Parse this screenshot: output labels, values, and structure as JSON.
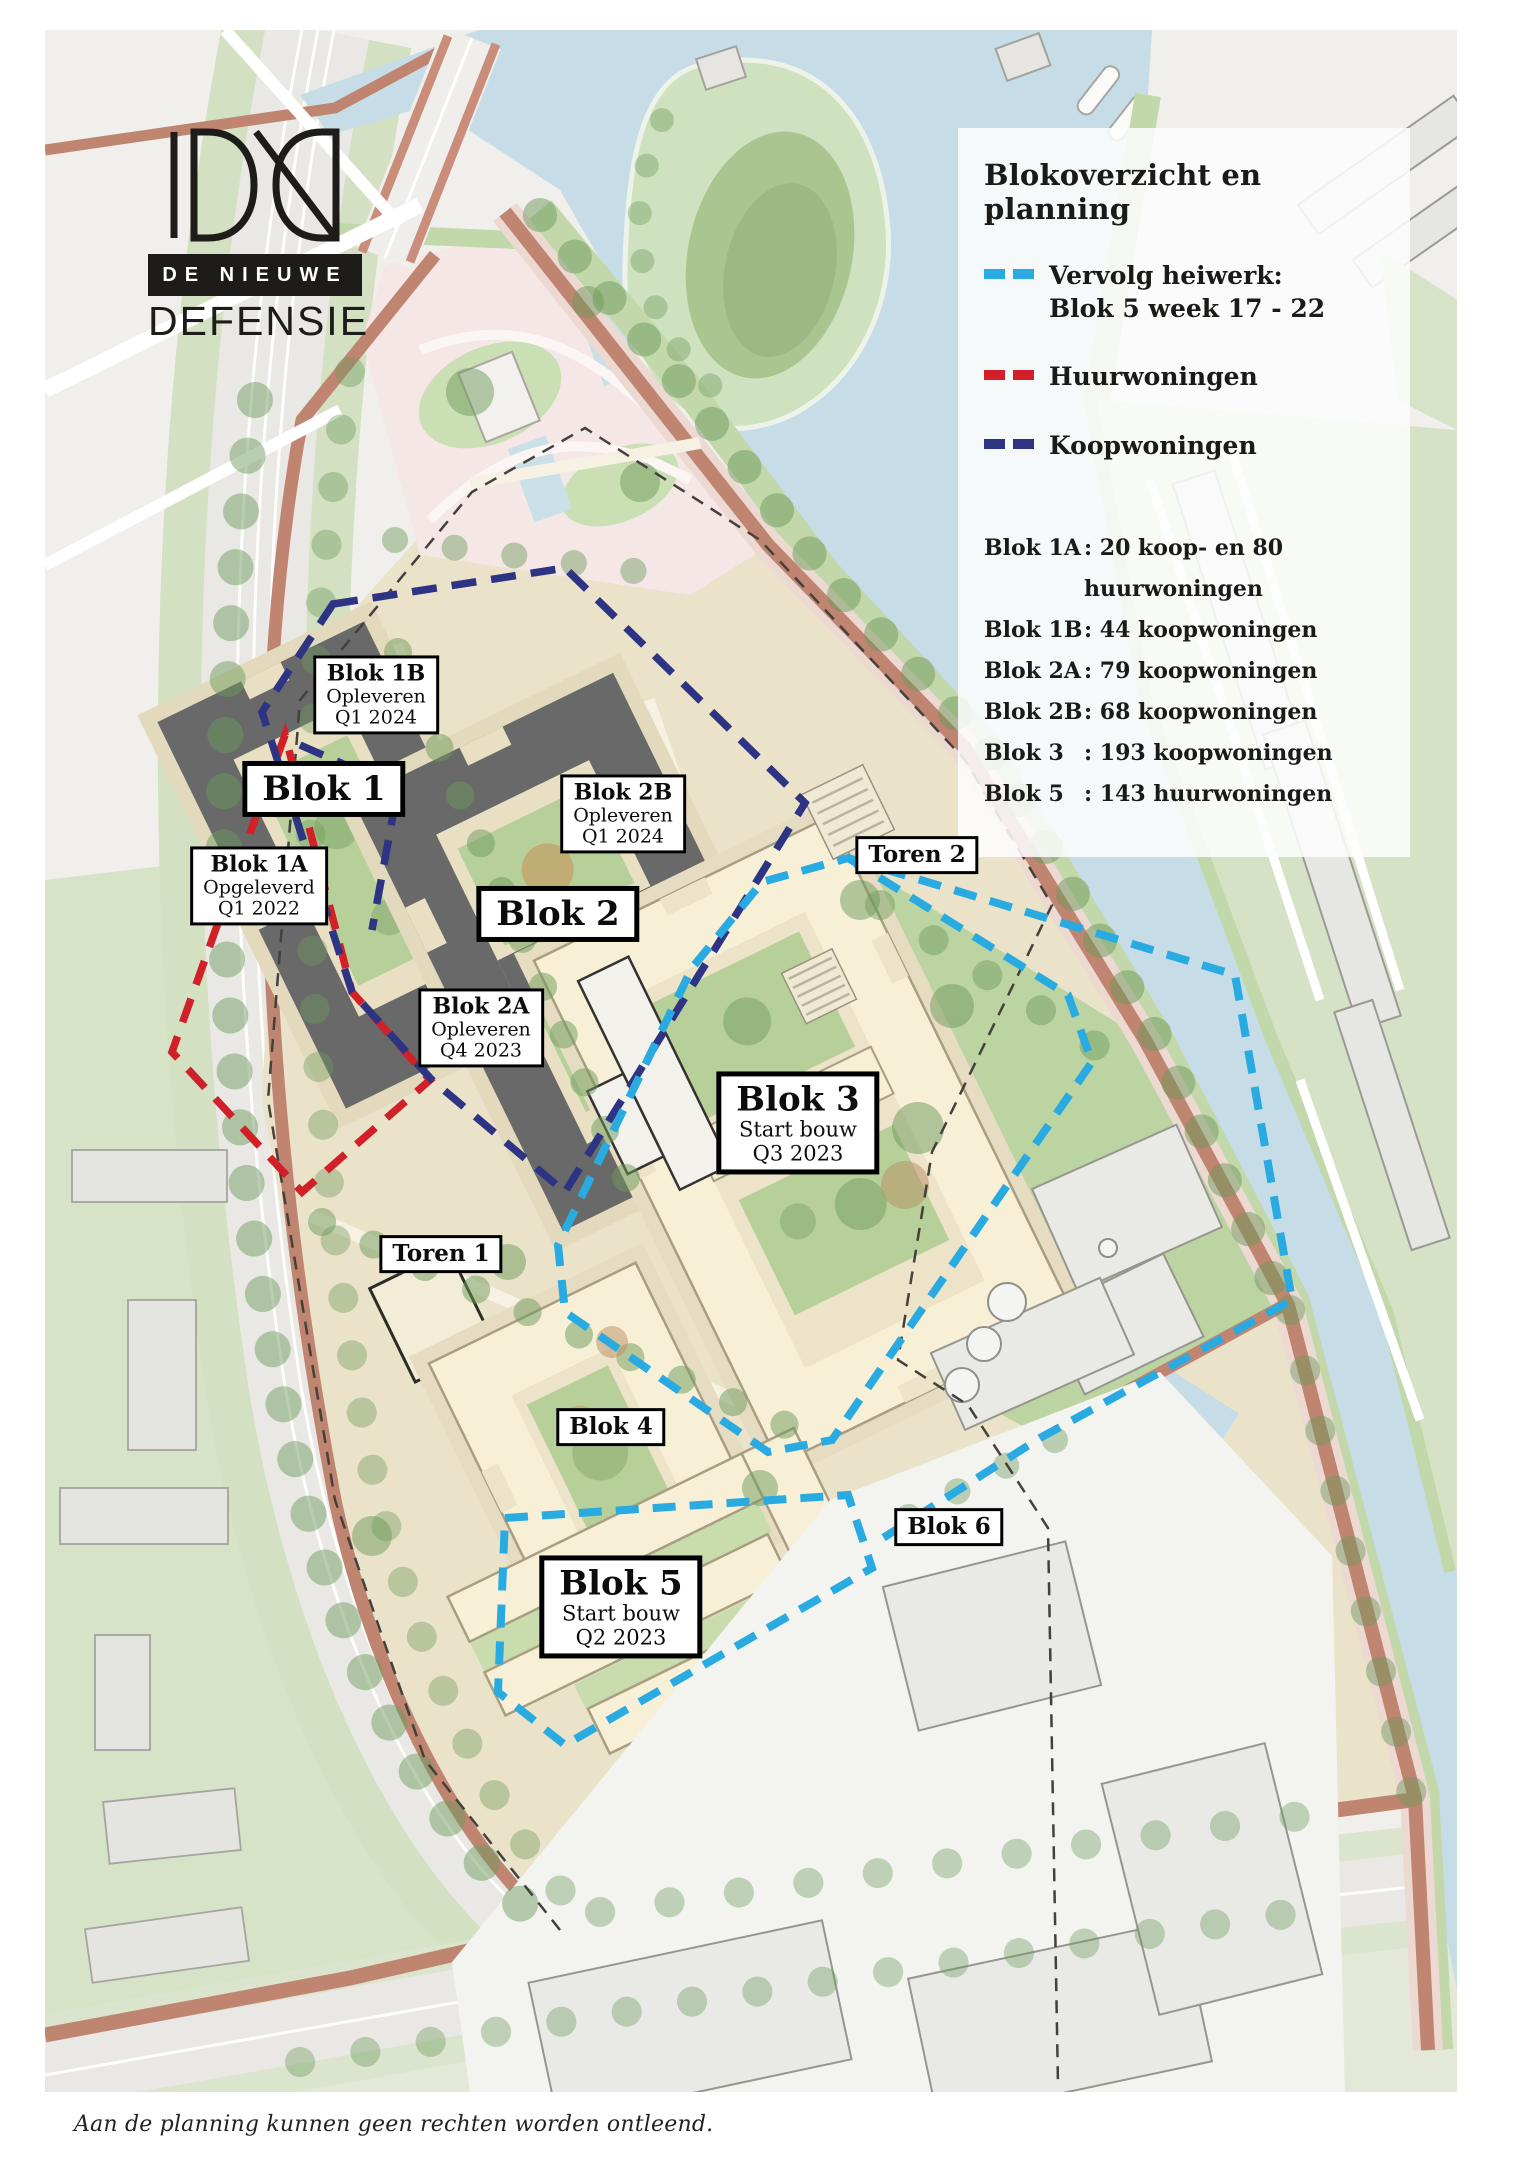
{
  "brand": {
    "line1": "DE NIEUWE",
    "line2": "DEFENSIE"
  },
  "legend": {
    "title": "Blokoverzicht en planning",
    "items": [
      {
        "id": "heiwerk",
        "color": "#29abe2",
        "line1": "Vervolg heiwerk:",
        "line2": "Blok 5 week 17 - 22"
      },
      {
        "id": "huurwoningen",
        "color": "#d12027",
        "line1": "Huurwoningen",
        "line2": ""
      },
      {
        "id": "koopwoningen",
        "color": "#2e3484",
        "line1": "Koopwoningen",
        "line2": ""
      }
    ],
    "blocks": [
      {
        "name": "Blok 1A",
        "value": ": 20 koop- en 80 huurwoningen"
      },
      {
        "name": "Blok 1B",
        "value": ": 44 koopwoningen"
      },
      {
        "name": "Blok 2A",
        "value": ": 79 koopwoningen"
      },
      {
        "name": "Blok 2B",
        "value": ": 68 koopwoningen"
      },
      {
        "name": "Blok 3",
        "value": ": 193 koopwoningen"
      },
      {
        "name": "Blok 5",
        "value": ": 143 huurwoningen"
      }
    ]
  },
  "map": {
    "labels": {
      "blok1b": {
        "title": "Blok 1B",
        "sub1": "Opleveren",
        "sub2": "Q1 2024"
      },
      "blok1": {
        "title": "Blok 1"
      },
      "blok1a": {
        "title": "Blok 1A",
        "sub1": "Opgeleverd",
        "sub2": "Q1 2022"
      },
      "blok2b": {
        "title": "Blok 2B",
        "sub1": "Opleveren",
        "sub2": "Q1 2024"
      },
      "blok2": {
        "title": "Blok 2"
      },
      "blok2a": {
        "title": "Blok 2A",
        "sub1": "Opleveren",
        "sub2": "Q4 2023"
      },
      "toren2": {
        "title": "Toren 2"
      },
      "blok3": {
        "title": "Blok 3",
        "sub1": "Start bouw",
        "sub2": "Q3 2023"
      },
      "toren1": {
        "title": "Toren 1"
      },
      "blok4": {
        "title": "Blok 4"
      },
      "blok5": {
        "title": "Blok 5",
        "sub1": "Start bouw",
        "sub2": "Q2 2023"
      },
      "blok6": {
        "title": "Blok 6"
      }
    }
  },
  "footer": {
    "disclaimer": "Aan de planning kunnen geen rechten worden ontleend."
  }
}
